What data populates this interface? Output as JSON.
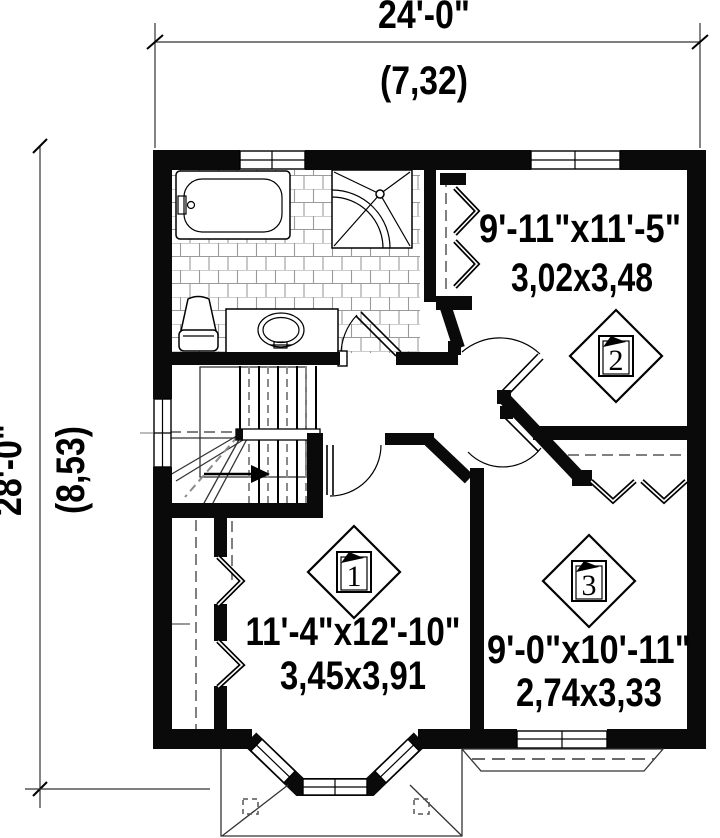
{
  "drawing": {
    "type": "floor-plan",
    "wall_color": "#0a0a0a",
    "background": "#ffffff"
  },
  "dimensions": {
    "width": {
      "feet": "24'-0\"",
      "meters": "(7,32)"
    },
    "depth": {
      "feet": "28'-0\"",
      "meters": "(8,53)"
    }
  },
  "rooms": {
    "room1": {
      "imperial": "11'-4\"x12'-10\"",
      "metric": "3,45x3,91",
      "marker": "1"
    },
    "room2": {
      "imperial": "9'-11\"x11'-5\"",
      "metric": "3,02x3,48",
      "marker": "2"
    },
    "room3": {
      "imperial": "9'-0\"x10'-11\"",
      "metric": "2,74x3,33",
      "marker": "3"
    }
  }
}
